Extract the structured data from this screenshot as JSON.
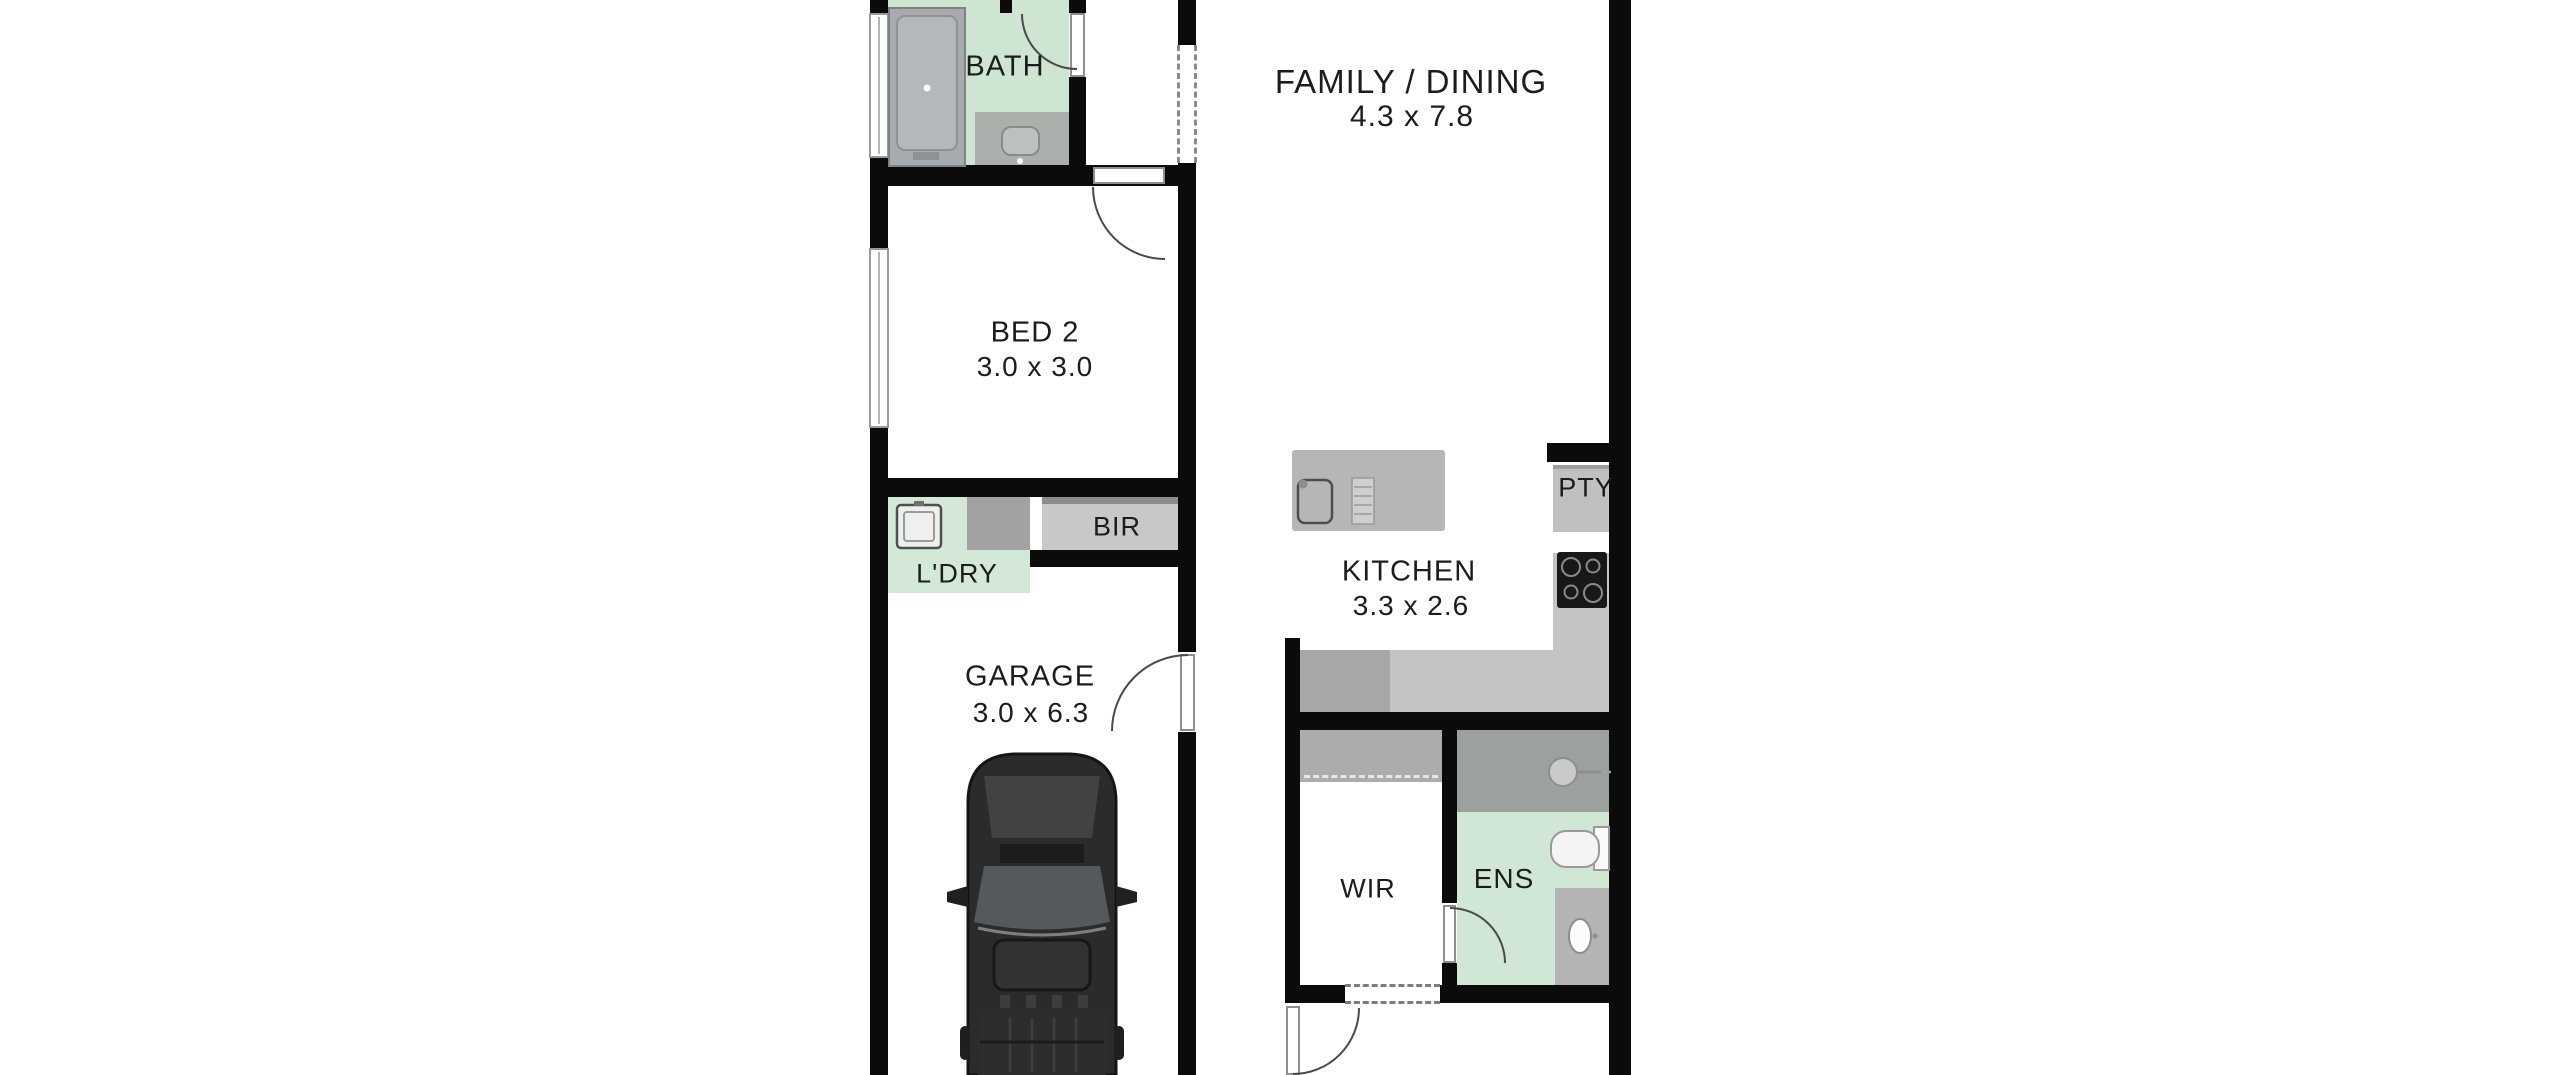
{
  "rooms": {
    "family": {
      "label": "FAMILY / DINING",
      "dims": "4.3 x 7.8"
    },
    "bath": {
      "label": "BATH"
    },
    "bed2": {
      "label": "BED 2",
      "dims": "3.0 x 3.0"
    },
    "bir": {
      "label": "BIR"
    },
    "laundry": {
      "label": "L'DRY"
    },
    "kitchen": {
      "label": "KITCHEN",
      "dims": "3.3 x 2.6"
    },
    "pantry": {
      "label": "PTY"
    },
    "garage": {
      "label": "GARAGE",
      "dims": "3.0 x 6.3"
    },
    "wir": {
      "label": "WIR"
    },
    "ens": {
      "label": "ENS"
    }
  },
  "colors": {
    "wall": "#0b0b0b",
    "floor_mint": "#cde5d1",
    "floor_mint_light": "#d4e8d7",
    "wet_area_gray": "#abb0ad",
    "shower_gray": "#9da19e",
    "cabinet_gray": "#c6c6c6",
    "bench_gray": "#b6b6b6",
    "car_body": "#2a2b2d",
    "text": "#1c1c1c"
  }
}
